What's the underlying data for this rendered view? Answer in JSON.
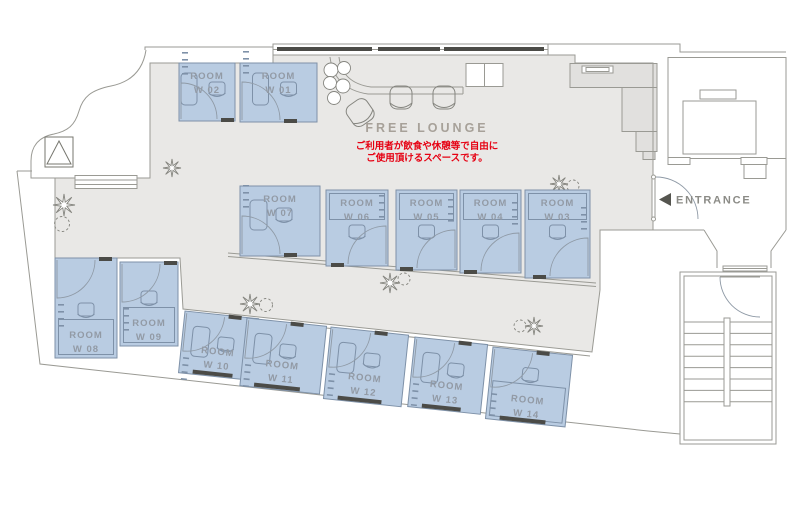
{
  "plan": {
    "lounge_label": "FREE LOUNGE",
    "lounge_note_line1": "ご利用者が飲食や休憩等で自由に",
    "lounge_note_line2": "ご使用頂けるスペースです。",
    "entrance_label": "ENTRANCE"
  },
  "rooms": [
    {
      "name": "ROOM",
      "number": "W 01"
    },
    {
      "name": "ROOM",
      "number": "W 02"
    },
    {
      "name": "ROOM",
      "number": "W 03"
    },
    {
      "name": "ROOM",
      "number": "W 04"
    },
    {
      "name": "ROOM",
      "number": "W 05"
    },
    {
      "name": "ROOM",
      "number": "W 06"
    },
    {
      "name": "ROOM",
      "number": "W 07"
    },
    {
      "name": "ROOM",
      "number": "W 08"
    },
    {
      "name": "ROOM",
      "number": "W 09"
    },
    {
      "name": "ROOM",
      "number": "W 10"
    },
    {
      "name": "ROOM",
      "number": "W 11"
    },
    {
      "name": "ROOM",
      "number": "W 12"
    },
    {
      "name": "ROOM",
      "number": "W 13"
    },
    {
      "name": "ROOM",
      "number": "W 14"
    }
  ],
  "colors": {
    "room_fill": "#b9cce2",
    "room_border": "#7e91a8",
    "floor": "#e9e8e6",
    "wall": "#9a9a94",
    "note_red": "#e60012",
    "room_label_gray": "#929aa5",
    "lounge_label_gray": "#a7a199",
    "entrance_gray": "#8b8b86",
    "sill_dark": "#4b4b47"
  }
}
